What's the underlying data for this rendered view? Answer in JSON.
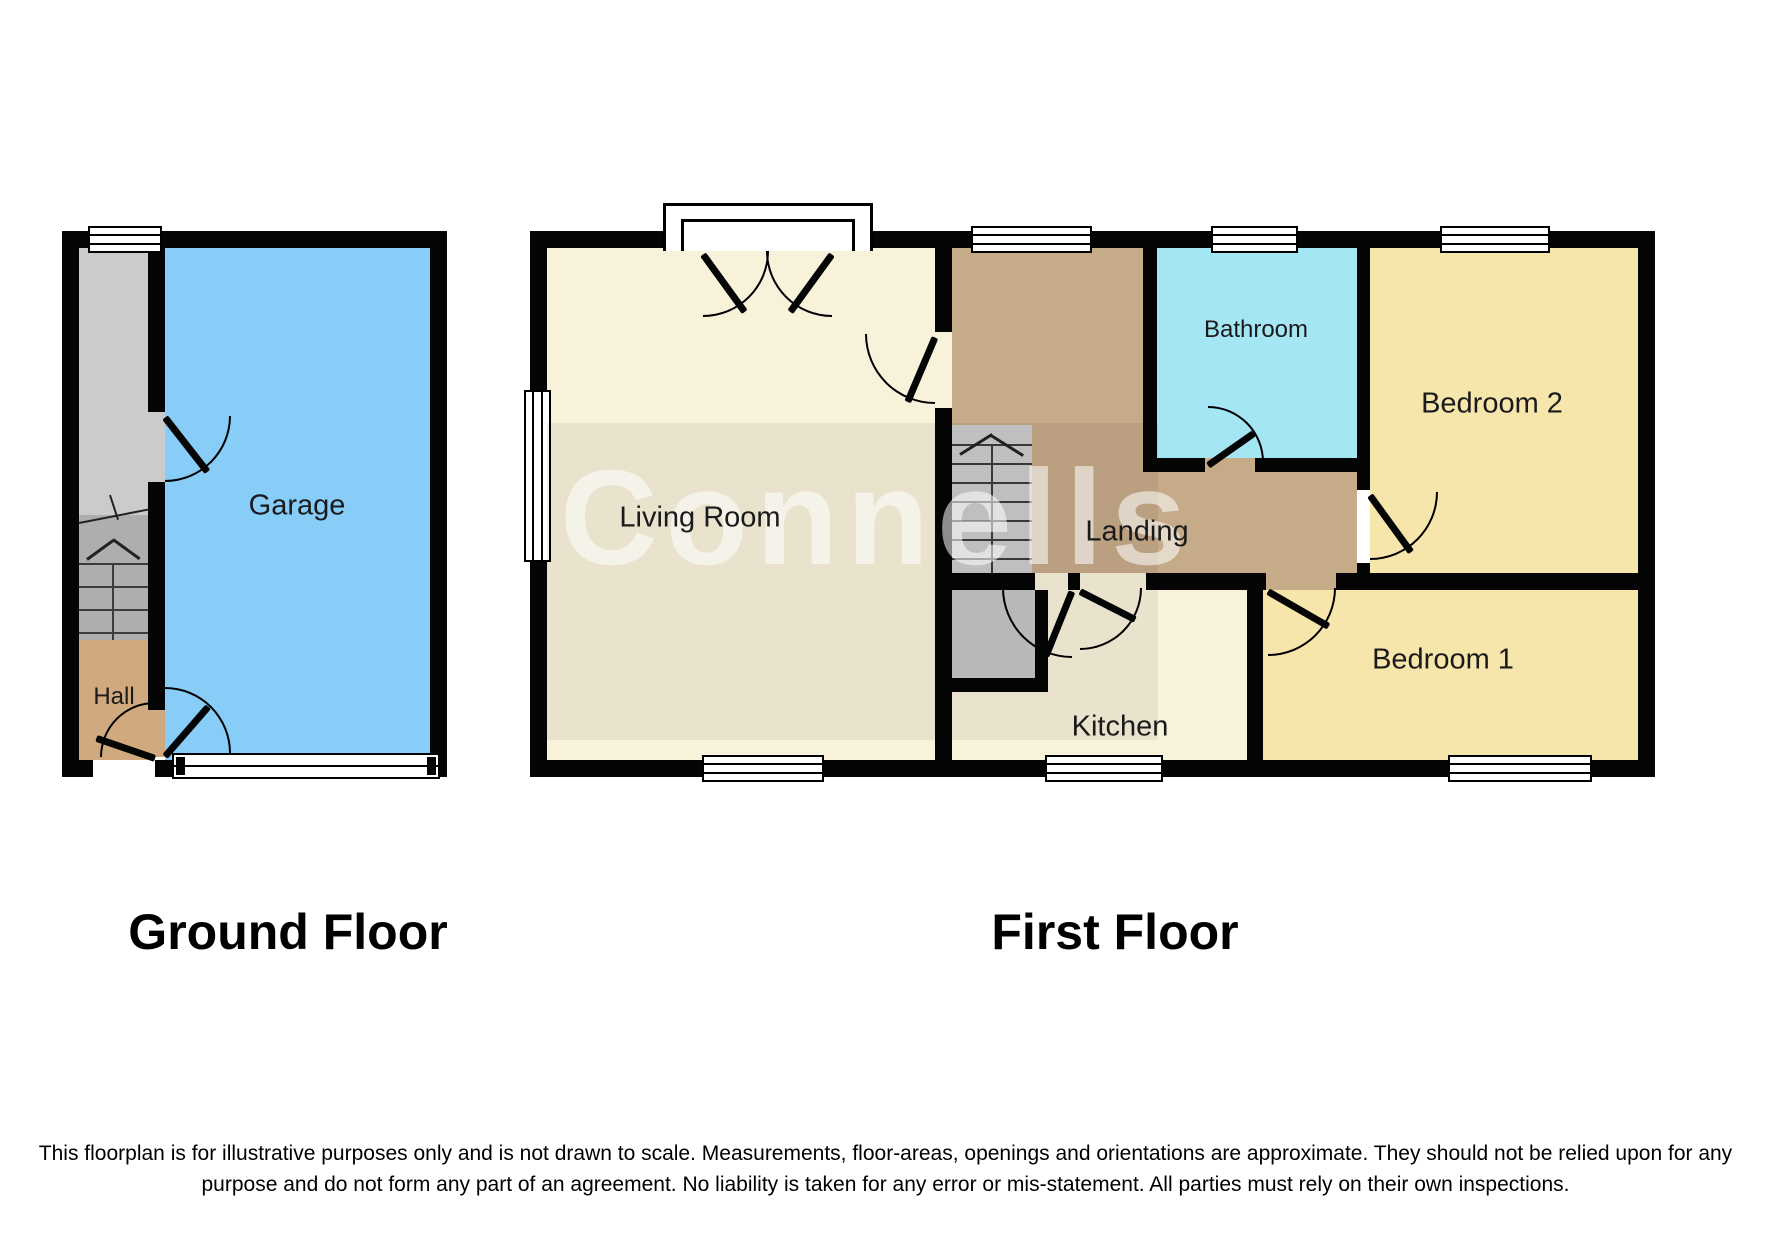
{
  "floorplan": {
    "ground": {
      "title": "Ground Floor",
      "rooms": {
        "garage": "Garage",
        "hall": "Hall"
      }
    },
    "first": {
      "title": "First Floor",
      "rooms": {
        "living_room": "Living Room",
        "kitchen": "Kitchen",
        "landing": "Landing",
        "bathroom": "Bathroom",
        "bedroom1": "Bedroom 1",
        "bedroom2": "Bedroom 2"
      }
    },
    "watermark": "Connells",
    "disclaimer": {
      "line1": "This floorplan is for illustrative purposes only and is not drawn to scale. Measurements, floor-areas, openings and orientations are approximate. They should not be relied upon for any",
      "line2": "purpose and do not form any part of an agreement. No liability is taken for any error or mis-statement. All parties must rely on their own inspections."
    }
  },
  "colors": {
    "garage": "#87CDF8",
    "bathroom": "#A5E6F5",
    "bedroom": "#F7E6AC",
    "landing": "#C6AB89",
    "hall": "#D0AA7E",
    "floor_cream": "#F8F2DB",
    "stairs": "#CBCBCB",
    "stairs_lower": "#AEAEAE",
    "closet": "#C4C4C4",
    "wall": "#050505"
  }
}
